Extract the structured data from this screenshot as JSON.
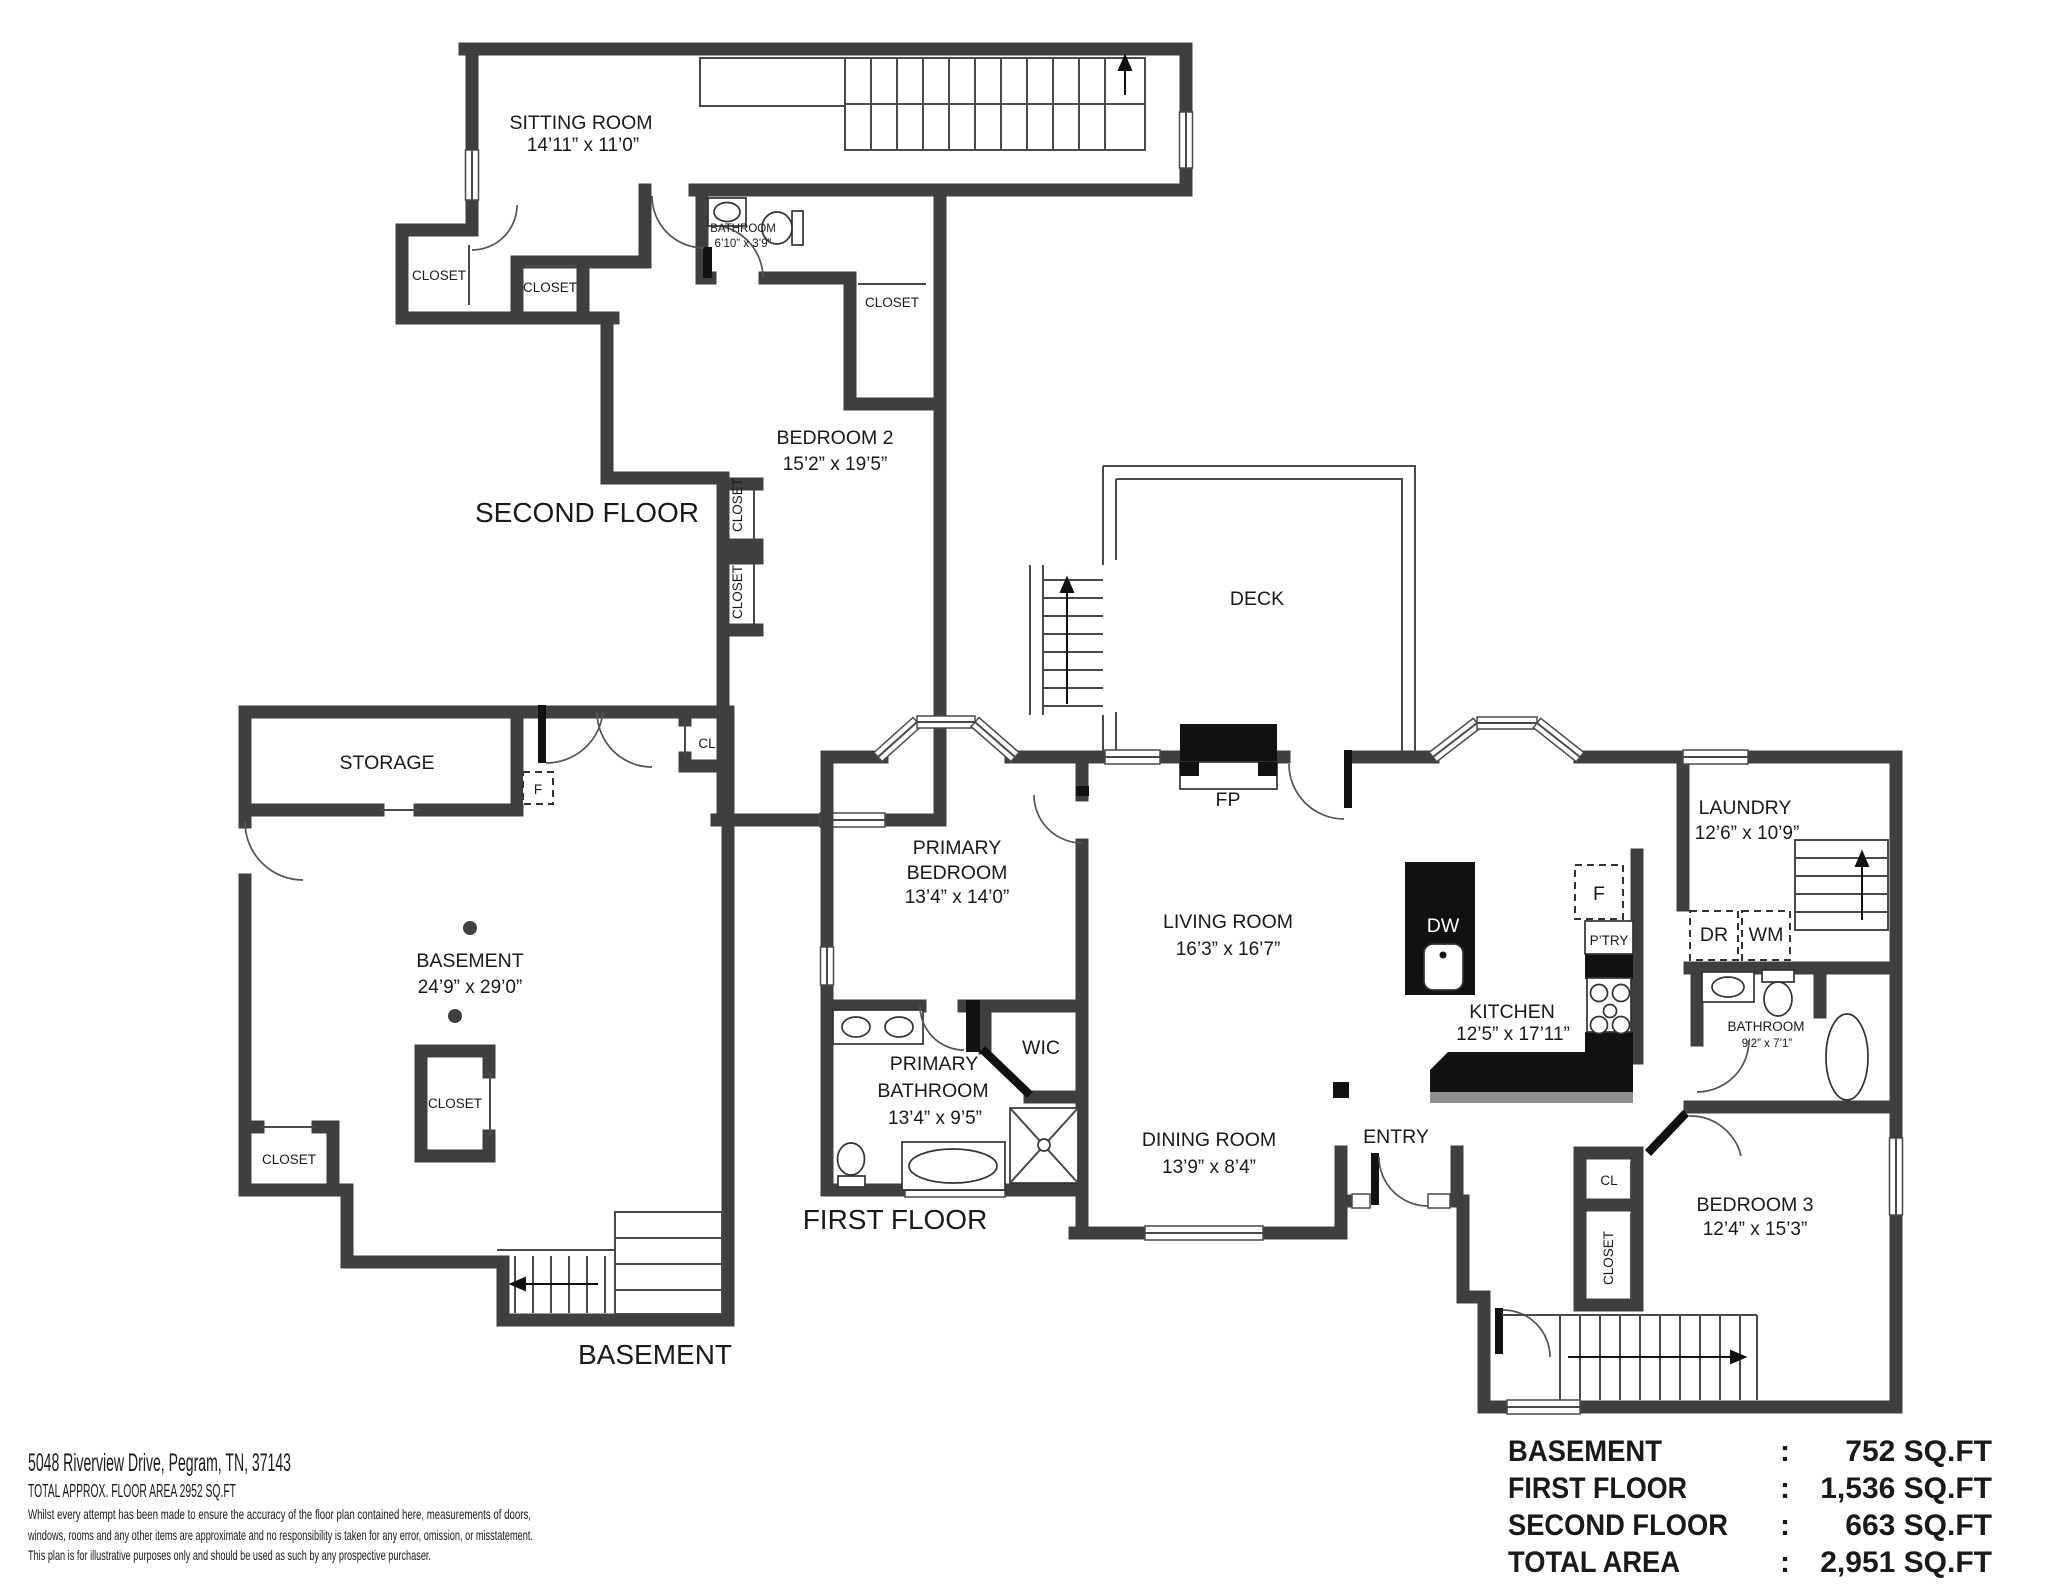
{
  "floors": {
    "second": {
      "title": "SECOND FLOOR",
      "rooms": {
        "sitting_room": {
          "name": "SITTING ROOM",
          "dims": "14’11” x 11’0”"
        },
        "bathroom": {
          "name": "BATHROOM",
          "dims": "6’10” x 3’9”"
        },
        "bedroom2": {
          "name": "BEDROOM 2",
          "dims": "15’2” x 19’5”"
        },
        "closet_left": {
          "name": "CLOSET"
        },
        "closet_mid": {
          "name": "CLOSET"
        },
        "closet_right": {
          "name": "CLOSET"
        },
        "closet_wall_upper": {
          "name": "CLOSET"
        },
        "closet_wall_lower": {
          "name": "CLOSET"
        }
      }
    },
    "first": {
      "title": "FIRST FLOOR",
      "rooms": {
        "deck": {
          "name": "DECK"
        },
        "fireplace": {
          "name": "FP"
        },
        "primary_bedroom": {
          "name1": "PRIMARY",
          "name2": "BEDROOM",
          "dims": "13’4” x 14’0”"
        },
        "living_room": {
          "name": "LIVING ROOM",
          "dims": "16’3” x 16’7”"
        },
        "kitchen": {
          "name": "KITCHEN",
          "dims": "12’5” x 17’11”"
        },
        "laundry": {
          "name": "LAUNDRY",
          "dims": "12’6” x 10’9”"
        },
        "dishwasher": {
          "name": "DW"
        },
        "fridge": {
          "name": "F"
        },
        "pantry": {
          "name": "P’TRY"
        },
        "dryer": {
          "name": "DR"
        },
        "washer": {
          "name": "WM"
        },
        "bathroom": {
          "name": "BATHROOM",
          "dims": "9’2” x 7’1”"
        },
        "primary_bathroom": {
          "name1": "PRIMARY",
          "name2": "BATHROOM",
          "dims": "13’4” x 9’5”"
        },
        "wic": {
          "name": "WIC"
        },
        "dining_room": {
          "name": "DINING ROOM",
          "dims": "13’9” x 8’4”"
        },
        "entry": {
          "name": "ENTRY"
        },
        "cl": {
          "name": "CL"
        },
        "closet": {
          "name": "CLOSET"
        },
        "bedroom3": {
          "name": "BEDROOM 3",
          "dims": "12’4” x 15’3”"
        }
      }
    },
    "basement": {
      "title": "BASEMENT",
      "rooms": {
        "storage": {
          "name": "STORAGE"
        },
        "fridge": {
          "name": "F"
        },
        "cl": {
          "name": "CL"
        },
        "basement_room": {
          "name": "BASEMENT",
          "dims": "24’9” x 29’0”"
        },
        "closet_center": {
          "name": "CLOSET"
        },
        "closet_left": {
          "name": "CLOSET"
        }
      }
    }
  },
  "footer": {
    "address": "5048 Riverview Drive, Pegram, TN, 37143",
    "total_area_line": "TOTAL APPROX. FLOOR AREA 2952 SQ.FT",
    "disclaimer_line1": "Whilst every attempt has been made to ensure the accuracy of the floor plan contained here, measurements of doors,",
    "disclaimer_line2": "windows, rooms and any other items are approximate and no responsibility is taken for any error, omission, or misstatement.",
    "disclaimer_line3": "This plan is for illustrative purposes only and should be used as such by any prospective purchaser."
  },
  "area_table": {
    "rows": [
      {
        "label": "BASEMENT",
        "sep": ":",
        "value": "752 SQ.FT"
      },
      {
        "label": "FIRST FLOOR",
        "sep": ":",
        "value": "1,536 SQ.FT"
      },
      {
        "label": "SECOND FLOOR",
        "sep": ":",
        "value": "663 SQ.FT"
      },
      {
        "label": "TOTAL AREA",
        "sep": ":",
        "value": "2,951 SQ.FT"
      }
    ]
  },
  "colors": {
    "wall": "#3f3f3f",
    "accent_black": "#111111",
    "text": "#1a1a1a"
  }
}
